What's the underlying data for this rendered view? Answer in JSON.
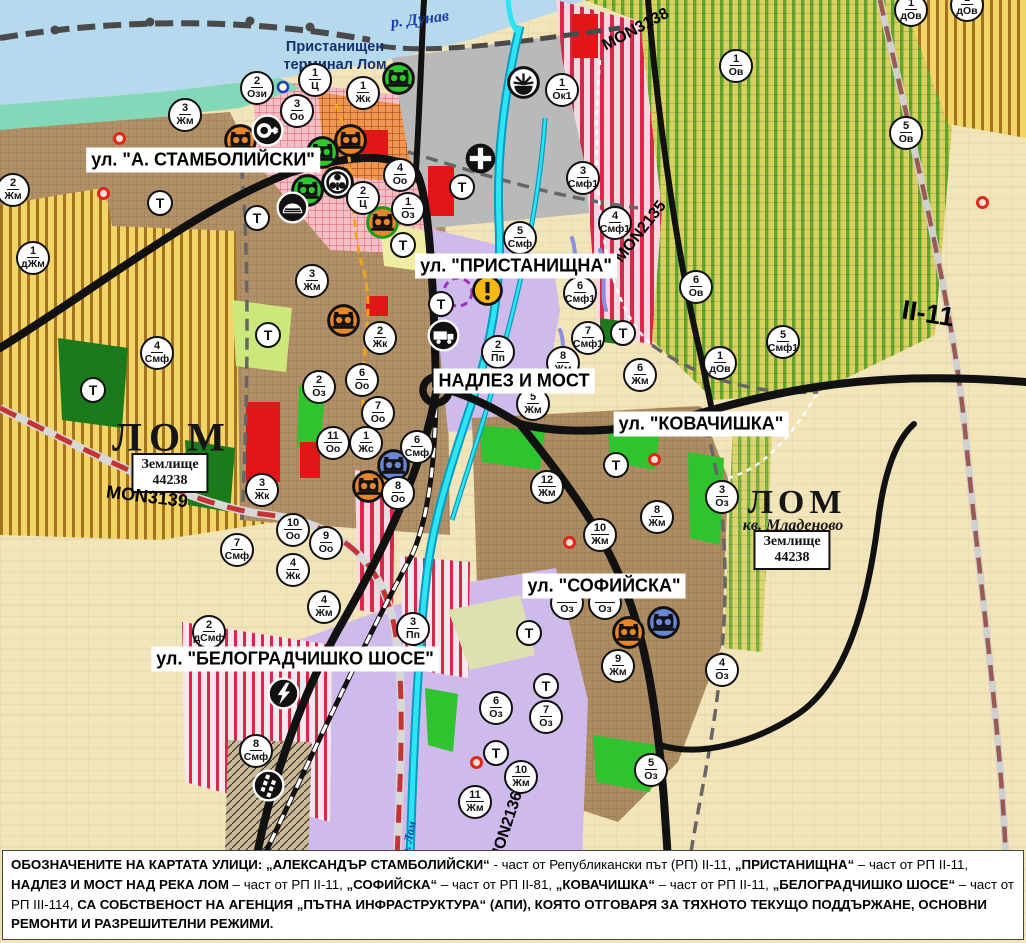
{
  "map": {
    "street_labels": [
      {
        "text": "ул. \"А. СТАМБОЛИЙСКИ\"",
        "x": 203,
        "y": 160
      },
      {
        "text": "ул. \"ПРИСТАНИЩНА\"",
        "x": 516,
        "y": 266
      },
      {
        "text": "НАДЛЕЗ И МОСТ",
        "x": 514,
        "y": 381
      },
      {
        "text": "ул. \"КОВАЧИШКА\"",
        "x": 701,
        "y": 424
      },
      {
        "text": "ул. \"СОФИЙСКА\"",
        "x": 604,
        "y": 586
      },
      {
        "text": "ул. \"БЕЛОГРАДЧИШКО ШОСЕ\"",
        "x": 295,
        "y": 659
      }
    ],
    "place_labels": [
      {
        "text": "р. Дунав",
        "kind": "river",
        "x": 420,
        "y": 20,
        "rot": -7
      },
      {
        "text": "Пристанищен",
        "kind": "terminal",
        "x": 335,
        "y": 47,
        "rot": 0
      },
      {
        "text": "терминал Лом",
        "kind": "terminal",
        "x": 335,
        "y": 65,
        "rot": 0
      },
      {
        "text": "ЛОМ",
        "kind": "city",
        "x": 172,
        "y": 437,
        "rot": 0
      },
      {
        "text": "ЛОМ",
        "kind": "city2",
        "x": 797,
        "y": 503,
        "rot": 0
      },
      {
        "text": "кв. Младеново",
        "kind": "district",
        "x": 793,
        "y": 526,
        "rot": 0
      },
      {
        "text": "р. Лом",
        "kind": "river-small",
        "x": 409,
        "y": 838,
        "rot": -78
      }
    ],
    "zemlishte_boxes": [
      {
        "line1": "Землище",
        "line2": "44238",
        "x": 170,
        "y": 473
      },
      {
        "line1": "Землище",
        "line2": "44238",
        "x": 792,
        "y": 550
      }
    ],
    "road_labels": [
      {
        "text": "MON3139",
        "x": 147,
        "y": 497,
        "rot": 7,
        "size": 18
      },
      {
        "text": "MON3138",
        "x": 636,
        "y": 30,
        "rot": -28,
        "size": 16
      },
      {
        "text": "MON2135",
        "x": 641,
        "y": 232,
        "rot": -52,
        "size": 16
      },
      {
        "text": "MON2136",
        "x": 507,
        "y": 827,
        "rot": -72,
        "size": 16
      },
      {
        "text": "II-11",
        "x": 928,
        "y": 314,
        "rot": 9,
        "size": 27
      }
    ],
    "t_label": "Т",
    "zone_markers": [
      {
        "n": "2",
        "c": "Ози",
        "x": 257,
        "y": 88
      },
      {
        "n": "1",
        "c": "Ц",
        "x": 315,
        "y": 80
      },
      {
        "n": "1",
        "c": "Жк",
        "x": 363,
        "y": 93
      },
      {
        "n": "3",
        "c": "Оо",
        "x": 297,
        "y": 111
      },
      {
        "n": "3",
        "c": "Жм",
        "x": 185,
        "y": 115
      },
      {
        "n": "2",
        "c": "Жм",
        "x": 13,
        "y": 190
      },
      {
        "n": "1",
        "c": "дЖм",
        "x": 33,
        "y": 258
      },
      {
        "n": "4",
        "c": "Оо",
        "x": 400,
        "y": 175
      },
      {
        "n": "2",
        "c": "Ц",
        "x": 363,
        "y": 198
      },
      {
        "n": "1",
        "c": "Оз",
        "x": 408,
        "y": 209
      },
      {
        "n": "3",
        "c": "Жм",
        "x": 312,
        "y": 281
      },
      {
        "n": "4",
        "c": "Смф",
        "x": 157,
        "y": 353
      },
      {
        "n": "1",
        "c": "Ок1",
        "x": 562,
        "y": 90
      },
      {
        "n": "3",
        "c": "Смф1",
        "x": 583,
        "y": 178
      },
      {
        "n": "4",
        "c": "Смф1",
        "x": 615,
        "y": 223
      },
      {
        "n": "5",
        "c": "Смф",
        "x": 520,
        "y": 238
      },
      {
        "n": "6",
        "c": "Смф1",
        "x": 580,
        "y": 293
      },
      {
        "n": "7",
        "c": "Смф1",
        "x": 588,
        "y": 338
      },
      {
        "n": "2",
        "c": "Пп",
        "x": 498,
        "y": 352
      },
      {
        "n": "2",
        "c": "Жк",
        "x": 380,
        "y": 338
      },
      {
        "n": "6",
        "c": "Оо",
        "x": 362,
        "y": 380
      },
      {
        "n": "2",
        "c": "Оз",
        "x": 319,
        "y": 387
      },
      {
        "n": "7",
        "c": "Оо",
        "x": 378,
        "y": 413
      },
      {
        "n": "11",
        "c": "Оо",
        "x": 333,
        "y": 443
      },
      {
        "n": "1",
        "c": "Жс",
        "x": 366,
        "y": 443
      },
      {
        "n": "6",
        "c": "Смф",
        "x": 417,
        "y": 447
      },
      {
        "n": "8",
        "c": "Оо",
        "x": 398,
        "y": 493
      },
      {
        "n": "3",
        "c": "Жк",
        "x": 262,
        "y": 490
      },
      {
        "n": "10",
        "c": "Оо",
        "x": 293,
        "y": 530
      },
      {
        "n": "9",
        "c": "Оо",
        "x": 326,
        "y": 543
      },
      {
        "n": "7",
        "c": "Смф",
        "x": 237,
        "y": 550
      },
      {
        "n": "4",
        "c": "Жк",
        "x": 293,
        "y": 570
      },
      {
        "n": "4",
        "c": "Жм",
        "x": 324,
        "y": 607
      },
      {
        "n": "2",
        "c": "дСмф",
        "x": 209,
        "y": 632
      },
      {
        "n": "3",
        "c": "Пп",
        "x": 413,
        "y": 629
      },
      {
        "n": "8",
        "c": "Смф",
        "x": 256,
        "y": 751
      },
      {
        "n": "8",
        "c": "Жм",
        "x": 563,
        "y": 363
      },
      {
        "n": "5",
        "c": "Жм",
        "x": 533,
        "y": 404
      },
      {
        "n": "6",
        "c": "Жм",
        "x": 640,
        "y": 375
      },
      {
        "n": "12",
        "c": "Жм",
        "x": 547,
        "y": 487
      },
      {
        "n": "8",
        "c": "Жм",
        "x": 657,
        "y": 517
      },
      {
        "n": "3",
        "c": "Оз",
        "x": 722,
        "y": 497
      },
      {
        "n": "10",
        "c": "Жм",
        "x": 600,
        "y": 535
      },
      {
        "n": "9",
        "c": "Жм",
        "x": 618,
        "y": 666
      },
      {
        "n": "4",
        "c": "Оз",
        "x": 722,
        "y": 670
      },
      {
        "n": "6",
        "c": "Оз",
        "x": 496,
        "y": 708
      },
      {
        "n": "7",
        "c": "Оз",
        "x": 546,
        "y": 717
      },
      {
        "n": "10",
        "c": "Жм",
        "x": 521,
        "y": 777
      },
      {
        "n": "11",
        "c": "Жм",
        "x": 475,
        "y": 802
      },
      {
        "n": "5",
        "c": "Оз",
        "x": 651,
        "y": 770
      },
      {
        "n": "1",
        "c": "Ов",
        "x": 736,
        "y": 66
      },
      {
        "n": "5",
        "c": "Ов",
        "x": 906,
        "y": 133
      },
      {
        "n": "1",
        "c": "дОв",
        "x": 911,
        "y": 10
      },
      {
        "n": "1",
        "c": "дОв",
        "x": 967,
        "y": 5
      },
      {
        "n": "6",
        "c": "Ов",
        "x": 696,
        "y": 287
      },
      {
        "n": "5",
        "c": "Смф1",
        "x": 783,
        "y": 342
      },
      {
        "n": "1",
        "c": "дОв",
        "x": 720,
        "y": 363
      },
      {
        "n": "",
        "c": "Оз",
        "x": 567,
        "y": 603
      },
      {
        "n": "",
        "c": "Оз",
        "x": 605,
        "y": 603
      }
    ],
    "t_markers": [
      {
        "x": 160,
        "y": 203
      },
      {
        "x": 257,
        "y": 218
      },
      {
        "x": 403,
        "y": 245
      },
      {
        "x": 441,
        "y": 304
      },
      {
        "x": 268,
        "y": 335
      },
      {
        "x": 93,
        "y": 390
      },
      {
        "x": 623,
        "y": 333
      },
      {
        "x": 616,
        "y": 465
      },
      {
        "x": 529,
        "y": 633
      },
      {
        "x": 546,
        "y": 686
      },
      {
        "x": 496,
        "y": 753
      },
      {
        "x": 462,
        "y": 187
      }
    ],
    "poi_markers": [
      {
        "type": "monument-orange",
        "x": 240,
        "y": 140
      },
      {
        "type": "monument-orange",
        "x": 350,
        "y": 140
      },
      {
        "type": "monument-orange",
        "x": 343,
        "y": 320
      },
      {
        "type": "monument-orange",
        "x": 368,
        "y": 486
      },
      {
        "type": "monument-orange",
        "x": 628,
        "y": 632
      },
      {
        "type": "monument-orange-ring",
        "x": 382,
        "y": 222
      },
      {
        "type": "monument-green",
        "x": 398,
        "y": 78
      },
      {
        "type": "monument-green",
        "x": 322,
        "y": 152
      },
      {
        "type": "monument-green",
        "x": 307,
        "y": 190
      },
      {
        "type": "monument-blue",
        "x": 393,
        "y": 465
      },
      {
        "type": "monument-blue",
        "x": 663,
        "y": 622
      },
      {
        "type": "key-icon",
        "x": 267,
        "y": 130
      },
      {
        "type": "trefoil-icon",
        "x": 337,
        "y": 182
      },
      {
        "type": "mound-icon",
        "x": 292,
        "y": 207
      },
      {
        "type": "cross-icon",
        "x": 480,
        "y": 158
      },
      {
        "type": "sun-dock-icon",
        "x": 523,
        "y": 82
      },
      {
        "type": "warning-icon",
        "x": 488,
        "y": 291
      },
      {
        "type": "truck-icon",
        "x": 443,
        "y": 335
      },
      {
        "type": "power-icon",
        "x": 283,
        "y": 693
      },
      {
        "type": "railcross-icon",
        "x": 268,
        "y": 785
      },
      {
        "type": "blue-ring",
        "x": 283,
        "y": 87
      },
      {
        "type": "red-dot",
        "x": 120,
        "y": 139
      },
      {
        "type": "red-dot",
        "x": 104,
        "y": 194
      },
      {
        "type": "red-dot",
        "x": 655,
        "y": 460
      },
      {
        "type": "red-dot",
        "x": 570,
        "y": 543
      },
      {
        "type": "red-dot",
        "x": 477,
        "y": 763
      },
      {
        "type": "red-dot",
        "x": 983,
        "y": 203
      }
    ],
    "colors": {
      "danube": "#b7d9ee",
      "shore": "#82d8b8",
      "port": "#b9b9b9",
      "agri_yellow": "#f2d566",
      "agri_stripe": "#a5731e",
      "vine_base": "#d8d160",
      "vine_stripe": "#61a52c",
      "smf_base": "#f7d7e2",
      "smf_stripe": "#d6294a",
      "residential_brown": "#b19067",
      "production_purple": "#cfbaec",
      "green_zone": "#2fc32f",
      "dark_green": "#1b7a1b",
      "river_cyan": "#2ce4f4",
      "road_black": "#111111",
      "mon3139_dash": "#c33535",
      "brown_road_dash": "#9a5a50",
      "red_patch": "#e11717",
      "cream": "#f3e5ba"
    }
  },
  "footer": {
    "segments": [
      {
        "t": "ОБОЗНАЧЕНИТЕ НА КАРТАТА УЛИЦИ: „АЛЕКСАНДЪР СТАМБОЛИЙСКИ“",
        "b": true
      },
      {
        "t": " - част от Републикански път (РП) II-11, ",
        "b": false
      },
      {
        "t": "„ПРИСТАНИЩНА“",
        "b": true
      },
      {
        "t": " – част от РП II-11, ",
        "b": false
      },
      {
        "t": "НАДЛЕЗ И МОСТ НАД РЕКА ЛОМ",
        "b": true
      },
      {
        "t": " – част от РП II-11, ",
        "b": false
      },
      {
        "t": "„СОФИЙСКА“",
        "b": true
      },
      {
        "t": " – част от РП II-81, ",
        "b": false
      },
      {
        "t": "„КОВАЧИШКА“",
        "b": true
      },
      {
        "t": " – част от РП II-11, ",
        "b": false
      },
      {
        "t": "„БЕЛОГРАДЧИШКО ШОСЕ“",
        "b": true
      },
      {
        "t": " – част от РП III-114, ",
        "b": false
      },
      {
        "t": "СА СОБСТВЕНОСТ НА АГЕНЦИЯ „ПЪТНА ИНФРАСТРУКТУРА“ (АПИ), КОЯТО ОТГОВАРЯ ЗА ТЯХНОТО ТЕКУЩО ПОДДЪРЖАНЕ, ОСНОВНИ РЕМОНТИ И РАЗРЕШИТЕЛНИ РЕЖИМИ.",
        "b": true
      }
    ]
  }
}
